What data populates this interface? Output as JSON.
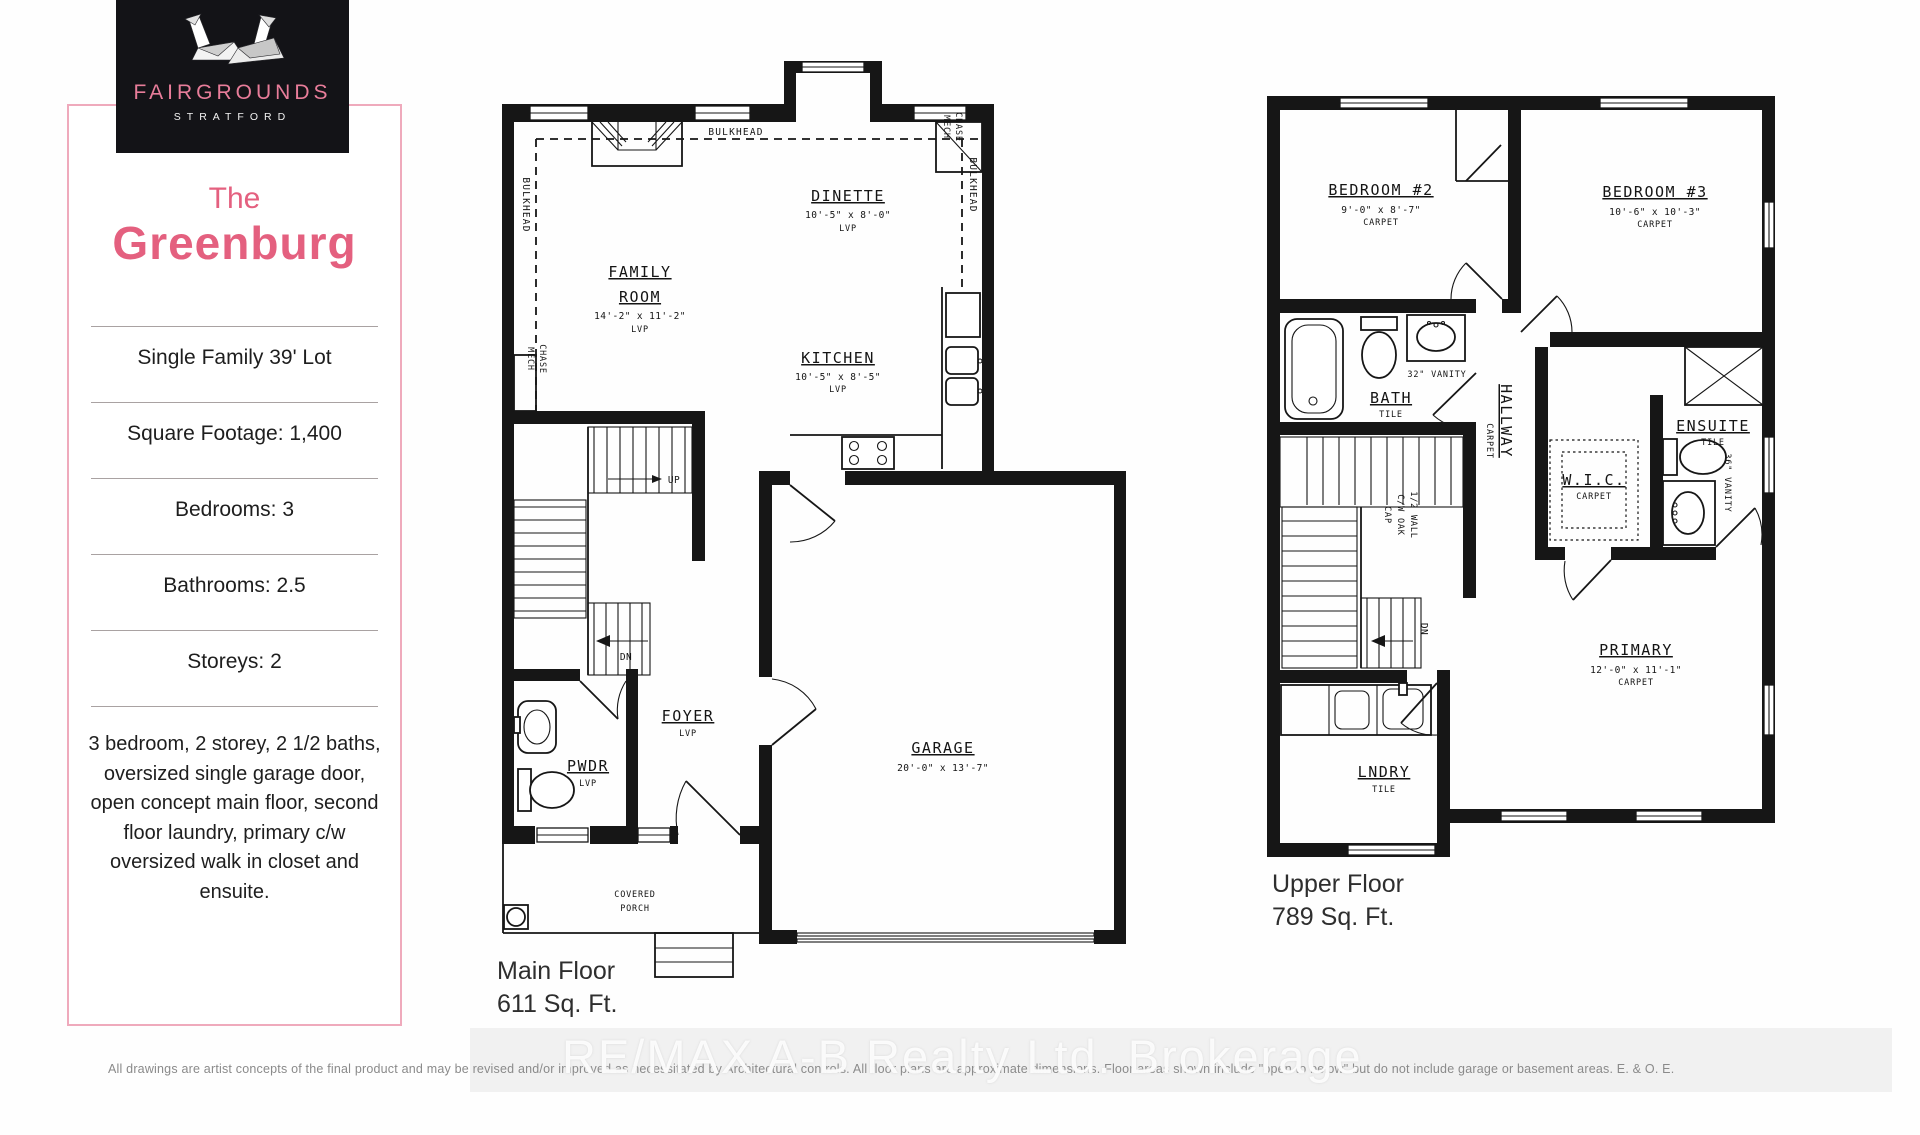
{
  "brand": {
    "logo_title": "FAIRGROUNDS",
    "logo_subtitle": "STRATFORD",
    "accent_pink": "#e4607f"
  },
  "panel": {
    "title_line1": "The",
    "title_line2": "Greenburg",
    "specs": [
      "Single Family 39' Lot",
      "Square Footage: 1,400",
      "Bedrooms: 3",
      "Bathrooms: 2.5",
      "Storeys: 2"
    ],
    "description": "3 bedroom, 2 storey, 2 1/2 baths, oversized single garage door, open concept main floor, second floor laundry, primary c/w oversized walk in closet and ensuite."
  },
  "main_floor": {
    "floor_name": "Main Floor",
    "area": "611 Sq. Ft.",
    "rooms": {
      "family_room": {
        "name1": "FAMILY",
        "name2": "ROOM",
        "dims": "14'-2\" x 11'-2\"",
        "floor": "LVP"
      },
      "dinette": {
        "name": "DINETTE",
        "dims": "10'-5\" x 8'-0\"",
        "floor": "LVP"
      },
      "kitchen": {
        "name": "KITCHEN",
        "dims": "10'-5\" x 8'-5\"",
        "floor": "LVP"
      },
      "foyer": {
        "name": "FOYER",
        "floor": "LVP"
      },
      "powder": {
        "name": "PWDR",
        "floor": "LVP"
      },
      "garage": {
        "name": "GARAGE",
        "dims": "20'-0\" x 13'-7\""
      },
      "porch": {
        "name1": "COVERED",
        "name2": "PORCH"
      }
    },
    "annotations": {
      "bulkhead": "BULKHEAD",
      "mech": "MECH",
      "chase": "CHASE",
      "up": "UP",
      "dn": "DN"
    }
  },
  "upper_floor": {
    "floor_name": "Upper Floor",
    "area": "789 Sq. Ft.",
    "rooms": {
      "bedroom2": {
        "name": "BEDROOM #2",
        "dims": "9'-0\" x 8'-7\"",
        "floor": "CARPET"
      },
      "bedroom3": {
        "name": "BEDROOM #3",
        "dims": "10'-6\" x 10'-3\"",
        "floor": "CARPET"
      },
      "bath": {
        "name": "BATH",
        "floor": "TILE",
        "vanity": "32\" VANITY"
      },
      "hallway": {
        "name": "HALLWAY",
        "floor": "CARPET"
      },
      "ensuite": {
        "name": "ENSUITE",
        "floor": "TILE",
        "vanity": "36\" VANITY"
      },
      "wic": {
        "name": "W.I.C.",
        "floor": "CARPET"
      },
      "primary": {
        "name": "PRIMARY",
        "dims": "12'-0\" x 11'-1\"",
        "floor": "CARPET"
      },
      "laundry": {
        "name": "LNDRY",
        "floor": "TILE"
      }
    },
    "annotations": {
      "half_wall1": "1/2 WALL",
      "half_wall2": "C/W OAK",
      "half_wall3": "CAP",
      "dn": "DN"
    }
  },
  "footer": {
    "watermark": "RE/MAX A-B Realty Ltd. Brokerage",
    "disclaimer": "All drawings are artist concepts of the final product and may be revised and/or improved as necessitated by Architectural controls. All floor plans are approximate dimensions. Floor areas shown include \"open to below\" but do not include garage or basement areas.   E. & O. E."
  }
}
